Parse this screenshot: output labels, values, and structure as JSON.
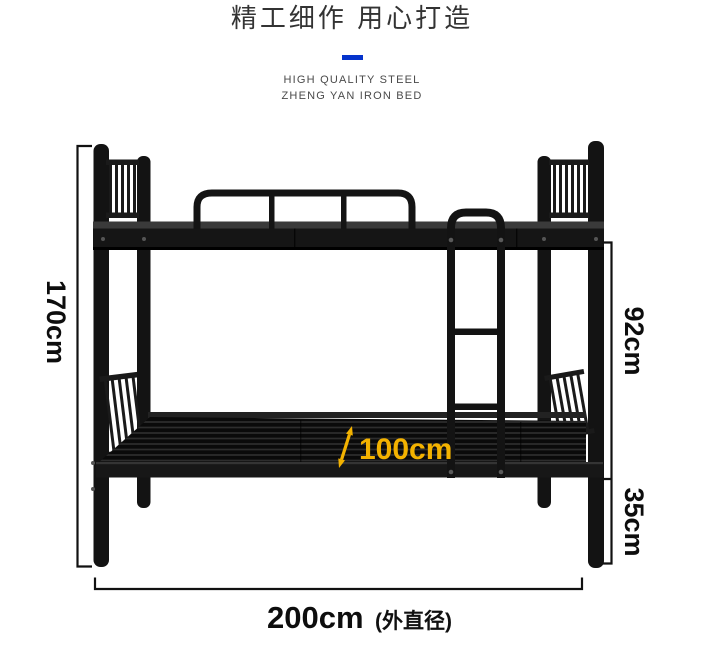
{
  "header": {
    "title": "精工细作 用心打造",
    "subtitle_line1": "HIGH QUALITY STEEL",
    "subtitle_line2": "ZHENG YAN IRON BED",
    "divider_color": "#0533cc"
  },
  "diagram": {
    "product_name": "steel bunk bed",
    "dimensions": {
      "total_height": "170cm",
      "upper_section_height": "92cm",
      "lower_section_height": "35cm",
      "inner_length": "100cm",
      "length_value": "200cm",
      "length_note": "(外直径)"
    },
    "colors": {
      "bed_frame": "#131313",
      "dimension_line": "#111111",
      "highlight": "#f3b200"
    }
  }
}
